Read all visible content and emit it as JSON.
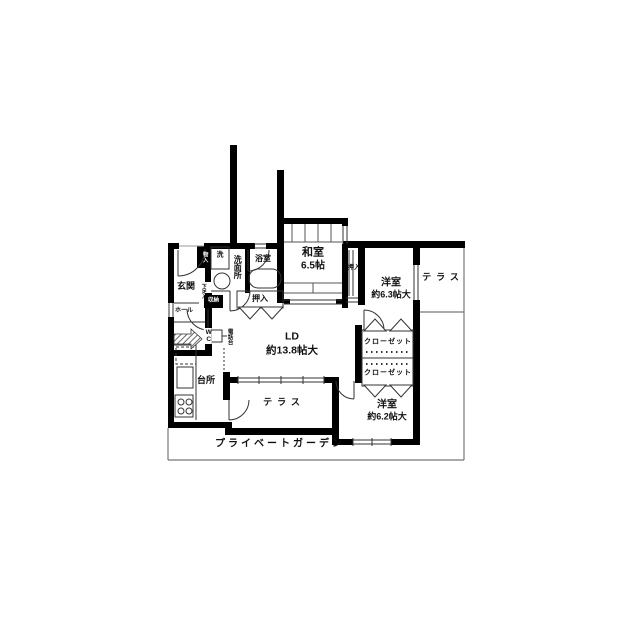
{
  "plan": {
    "rooms": {
      "washitsu": {
        "name": "和室",
        "size": "6.5帖"
      },
      "youshitsu_ne": {
        "name": "洋室",
        "size": "約6.3帖大"
      },
      "youshitsu_se": {
        "name": "洋室",
        "size": "約6.2帖大"
      },
      "ld": {
        "name": "LD",
        "size": "約13.8帖大"
      },
      "kitchen": {
        "name": "台所"
      },
      "genkan": {
        "name": "玄関"
      },
      "hall": {
        "name": "ホール"
      },
      "wc": {
        "name": "WC"
      },
      "bath": {
        "name": "浴室"
      },
      "senmenjo": {
        "name": "洗面所"
      },
      "washer": {
        "name": "洗"
      },
      "closet_upper": {
        "name": "クローゼット"
      },
      "closet_lower": {
        "name": "クローゼット"
      },
      "oshiire_center": {
        "name": "押入"
      },
      "oshiire_right": {
        "name": "押入"
      },
      "terrace_east": {
        "name": "テラス"
      },
      "terrace_south": {
        "name": "テラス"
      },
      "garden": {
        "name": "プライベートガーデン"
      },
      "monoire": {
        "name": "物入"
      },
      "getabako": {
        "name": "下足入"
      },
      "shunou": {
        "name": "収納"
      },
      "denwadai": {
        "name": "電話台"
      }
    },
    "colors": {
      "wall": "#000000",
      "line": "#333333",
      "background": "#ffffff"
    }
  }
}
